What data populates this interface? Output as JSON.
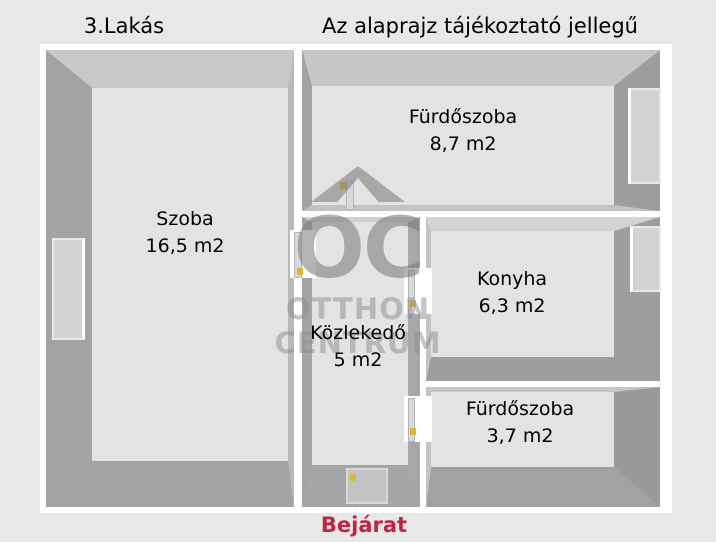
{
  "header": {
    "apartment": "3.Lakás",
    "disclaimer": "Az alaprajz tájékoztató jellegű"
  },
  "rooms": [
    {
      "name": "Szoba",
      "area": "16,5 m2"
    },
    {
      "name": "Fürdőszoba",
      "area": "8,7 m2"
    },
    {
      "name": "Konyha",
      "area": "6,3 m2"
    },
    {
      "name": "Közlekedő",
      "area": "5 m2"
    },
    {
      "name": "Fürdőszoba",
      "area": "3,7 m2"
    }
  ],
  "entrance": {
    "label": "Bejárat"
  },
  "watermark": {
    "brand_initials": "OC",
    "brand_line1": "OTTHON",
    "brand_line2": "CENTRUM"
  },
  "colors": {
    "background": "#e8e8e8",
    "floor": "#e3e3e3",
    "wall": "#a2a2a2",
    "wall_light": "#cccccc",
    "entrance_text": "#bf2441",
    "door_handle": "#d8b93c",
    "watermark_gray": "#767676"
  }
}
